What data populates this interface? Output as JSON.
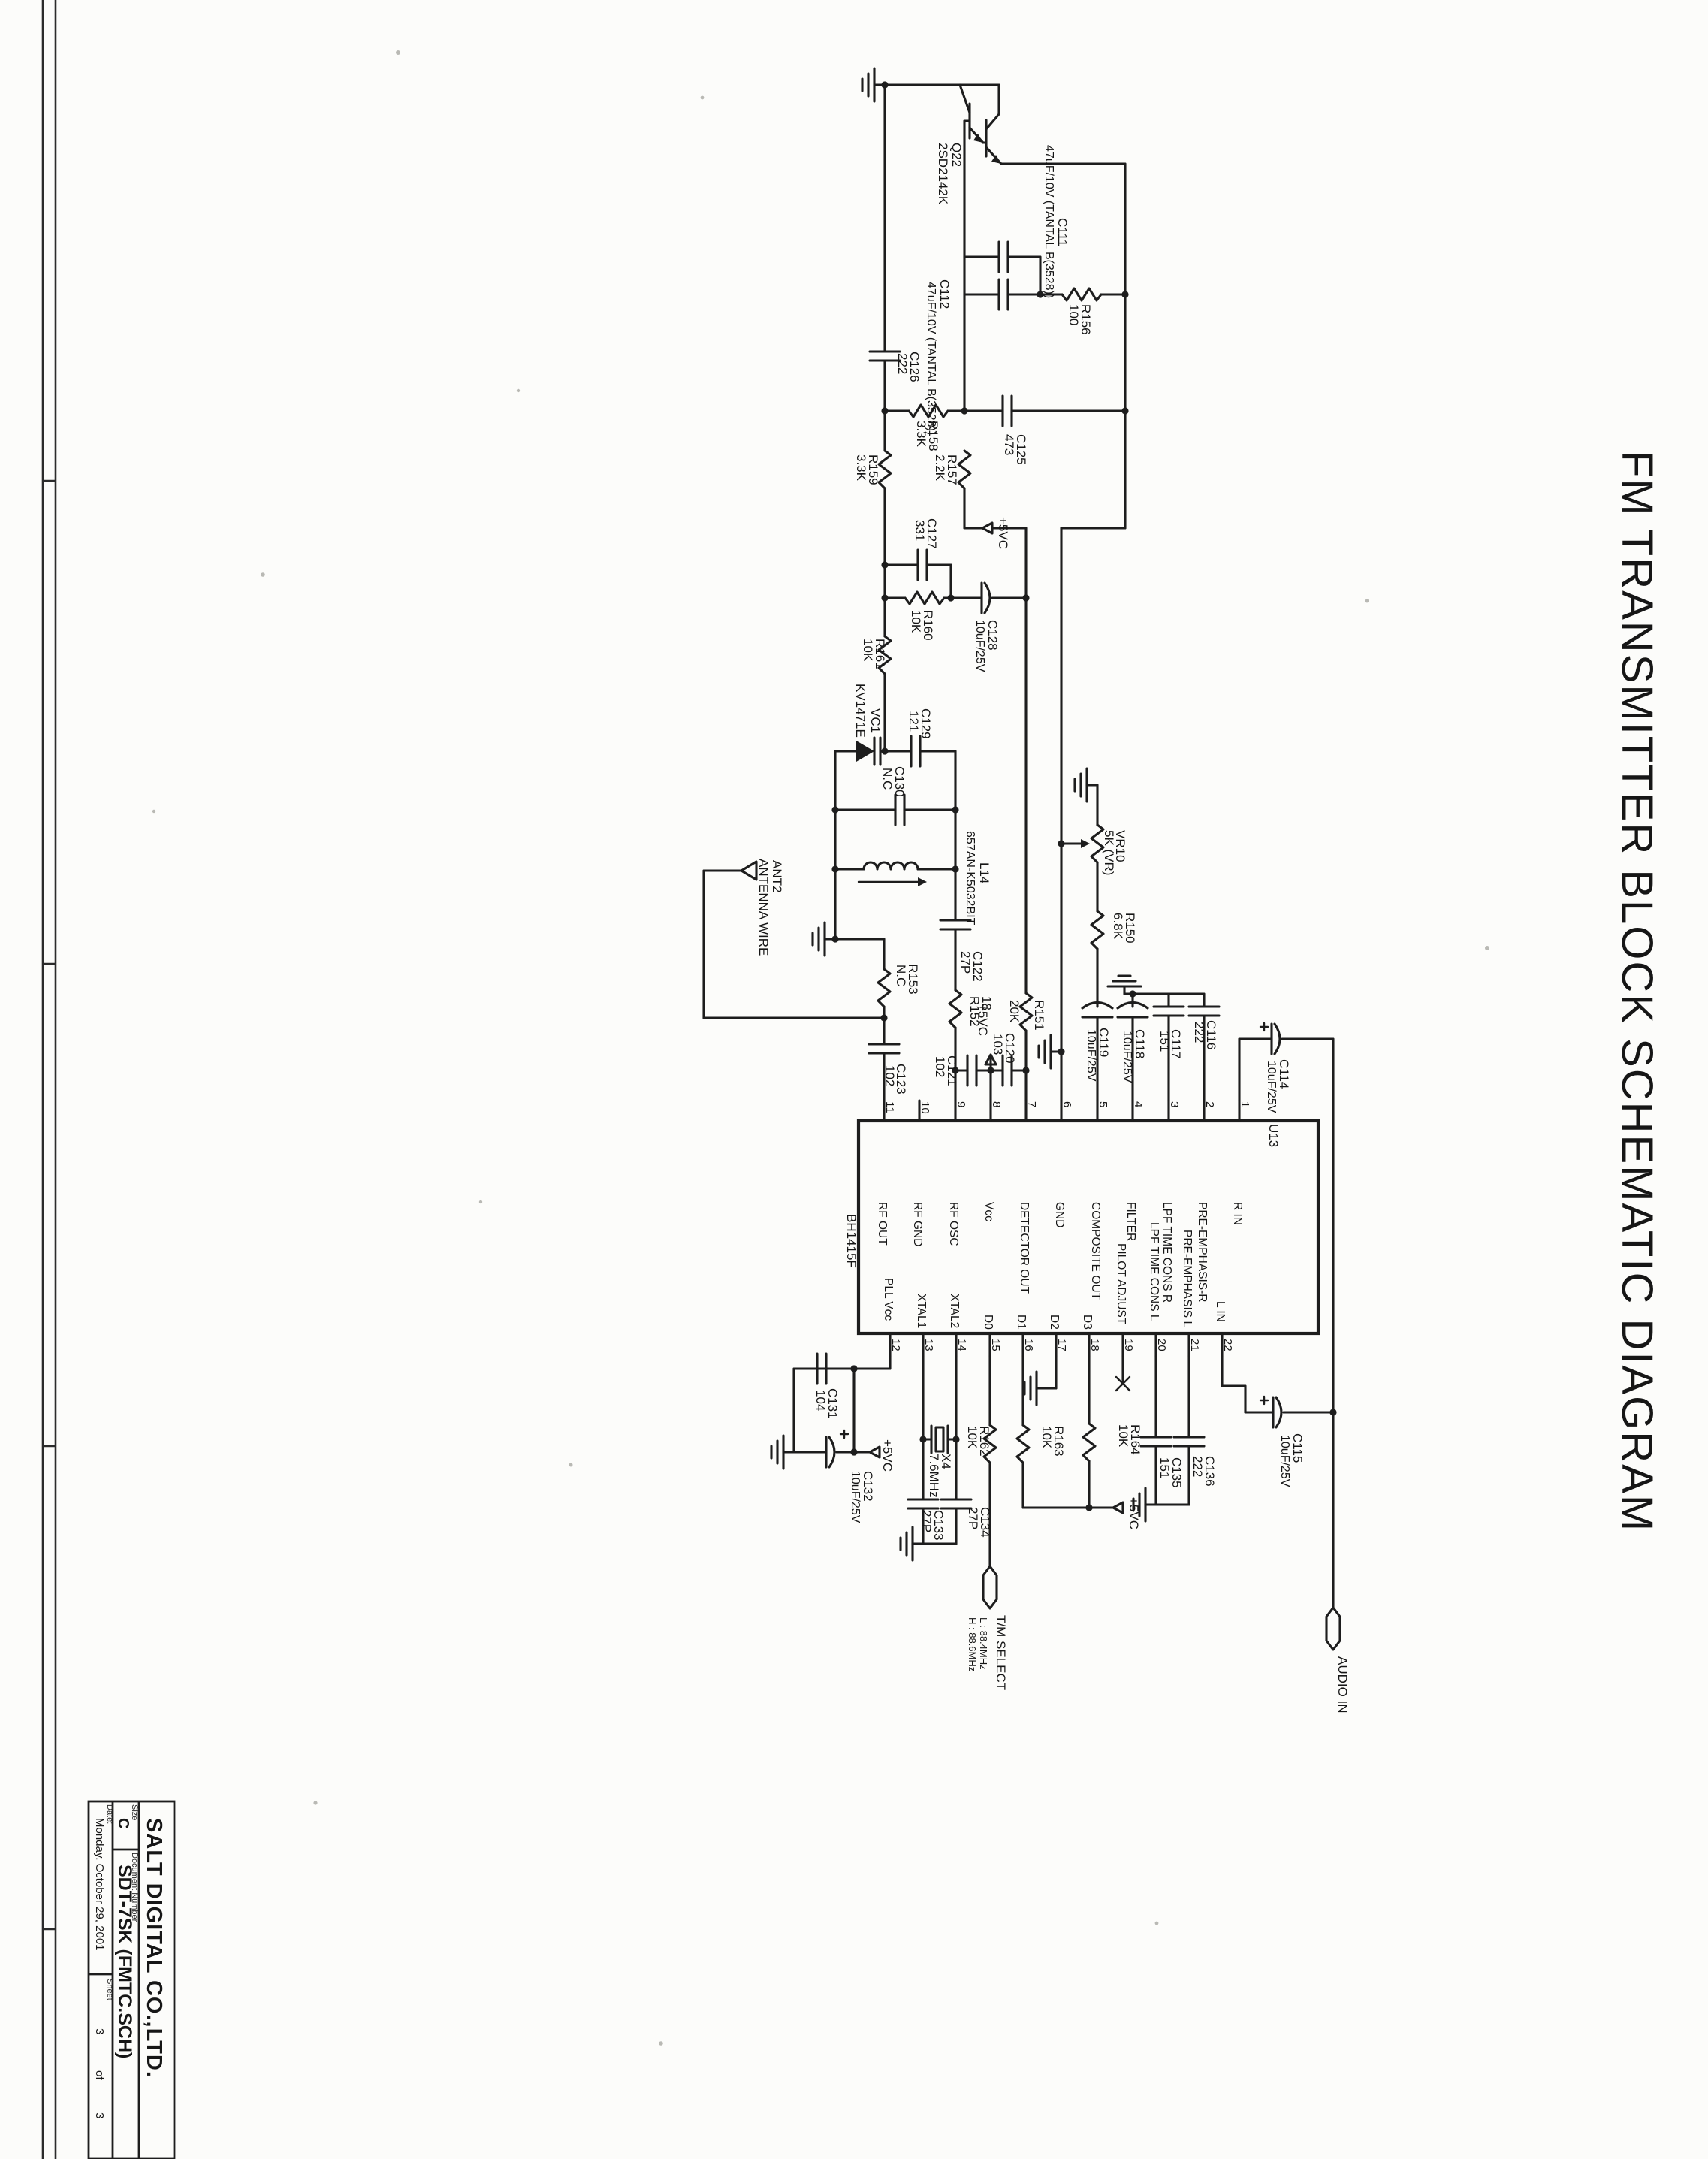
{
  "title": "FM TRANSMITTER BLOCK SCHEMATIC DIAGRAM",
  "title_block": {
    "company": "SALT DIGITAL CO.,LTD.",
    "size_label": "Size",
    "size": "C",
    "doc_label": "Document Number",
    "doc_number": "SDT-7SK (FMTC.SCH)",
    "date_label": "Date:",
    "date": "Monday, October 29, 2001",
    "sheet_label": "Sheet",
    "sheet_num": "3",
    "of_label": "of",
    "sheet_total": "3"
  },
  "pwr": "+5VC",
  "conn": {
    "ant_ref": "ANT2",
    "ant_name": "ANTENNA WIRE",
    "select_name": "T/M SELECT",
    "select_low": "L : 88.4MHz",
    "select_high": "H : 88.6MHz",
    "audio_in": "AUDIO IN"
  },
  "ic": {
    "ref": "U13",
    "part": "BH1415F",
    "top": [
      {
        "n": "11",
        "l": "RF OUT"
      },
      {
        "n": "10",
        "l": "RF GND"
      },
      {
        "n": "9",
        "l": "RF OSC"
      },
      {
        "n": "8",
        "l": "Vcc"
      },
      {
        "n": "7",
        "l": "DETECTOR OUT"
      },
      {
        "n": "6",
        "l": "GND"
      },
      {
        "n": "5",
        "l": "COMPOSITE OUT"
      },
      {
        "n": "4",
        "l": "FILTER"
      },
      {
        "n": "3",
        "l": "LPF TIME CONS R"
      },
      {
        "n": "2",
        "l": "PRE-EMPHASIS-R"
      },
      {
        "n": "1",
        "l": "R IN"
      }
    ],
    "bot": [
      {
        "n": "12",
        "l": "PLL Vcc"
      },
      {
        "n": "13",
        "l": "XTAL1"
      },
      {
        "n": "14",
        "l": "XTAL2"
      },
      {
        "n": "15",
        "l": "D0"
      },
      {
        "n": "16",
        "l": "D1"
      },
      {
        "n": "17",
        "l": "D2"
      },
      {
        "n": "18",
        "l": "D3"
      },
      {
        "n": "19",
        "l": "PILOT ADJUST"
      },
      {
        "n": "20",
        "l": "LPF TIME CONS L"
      },
      {
        "n": "21",
        "l": "PRE-EMPHASIS L"
      },
      {
        "n": "22",
        "l": "L IN"
      }
    ]
  },
  "comp": {
    "q22": {
      "r": "Q22",
      "v": "2SD2142K"
    },
    "vc1": {
      "r": "VC1",
      "v": "KV1471E"
    },
    "l14": {
      "r": "L14",
      "v": "657AN-K5032BIT"
    },
    "x4": {
      "r": "X4",
      "v": "7.6MHz"
    },
    "vr10": {
      "r": "VR10",
      "v": "5K (VR)"
    },
    "r150": {
      "r": "R150",
      "v": "6.8K"
    },
    "r151": {
      "r": "R151",
      "v": "20K"
    },
    "r152": {
      "r": "R152",
      "v": "18"
    },
    "r153": {
      "r": "R153",
      "v": "N.C"
    },
    "r156": {
      "r": "R156",
      "v": "100"
    },
    "r157": {
      "r": "R157",
      "v": "2.2K"
    },
    "r158": {
      "r": "R158",
      "v": "3.3K"
    },
    "r159": {
      "r": "R159",
      "v": "3.3K"
    },
    "r160": {
      "r": "R160",
      "v": "10K"
    },
    "r161": {
      "r": "R161",
      "v": "10K"
    },
    "r162": {
      "r": "R162",
      "v": "10K"
    },
    "r163": {
      "r": "R163",
      "v": "10K"
    },
    "r164": {
      "r": "R164",
      "v": "10K"
    },
    "c111": {
      "r": "C111",
      "v": "47uF/10V (TANTAL B(3528))"
    },
    "c112": {
      "r": "C112",
      "v": "47uF/10V (TANTAL B(3528))"
    },
    "c114": {
      "r": "C114",
      "v": "10uF/25V"
    },
    "c115": {
      "r": "C115",
      "v": "10uF/25V"
    },
    "c116": {
      "r": "C116",
      "v": "222"
    },
    "c117": {
      "r": "C117",
      "v": "151"
    },
    "c118": {
      "r": "C118",
      "v": "10uF/25V"
    },
    "c119": {
      "r": "C119",
      "v": "10uF/25V"
    },
    "c120": {
      "r": "C120",
      "v": "103"
    },
    "c121": {
      "r": "C121",
      "v": "102"
    },
    "c122": {
      "r": "C122",
      "v": "27P"
    },
    "c123": {
      "r": "C123",
      "v": "102"
    },
    "c125": {
      "r": "C125",
      "v": "473"
    },
    "c126": {
      "r": "C126",
      "v": "222"
    },
    "c127": {
      "r": "C127",
      "v": "331"
    },
    "c128": {
      "r": "C128",
      "v": "10uF/25V"
    },
    "c129": {
      "r": "C129",
      "v": "121"
    },
    "c130": {
      "r": "C130",
      "v": "N.C"
    },
    "c131": {
      "r": "C131",
      "v": "104"
    },
    "c132": {
      "r": "C132",
      "v": "10uF/25V"
    },
    "c133": {
      "r": "C133",
      "v": "27P"
    },
    "c134": {
      "r": "C134",
      "v": "27P"
    },
    "c135": {
      "r": "C135",
      "v": "151"
    },
    "c136": {
      "r": "C136",
      "v": "222"
    }
  }
}
